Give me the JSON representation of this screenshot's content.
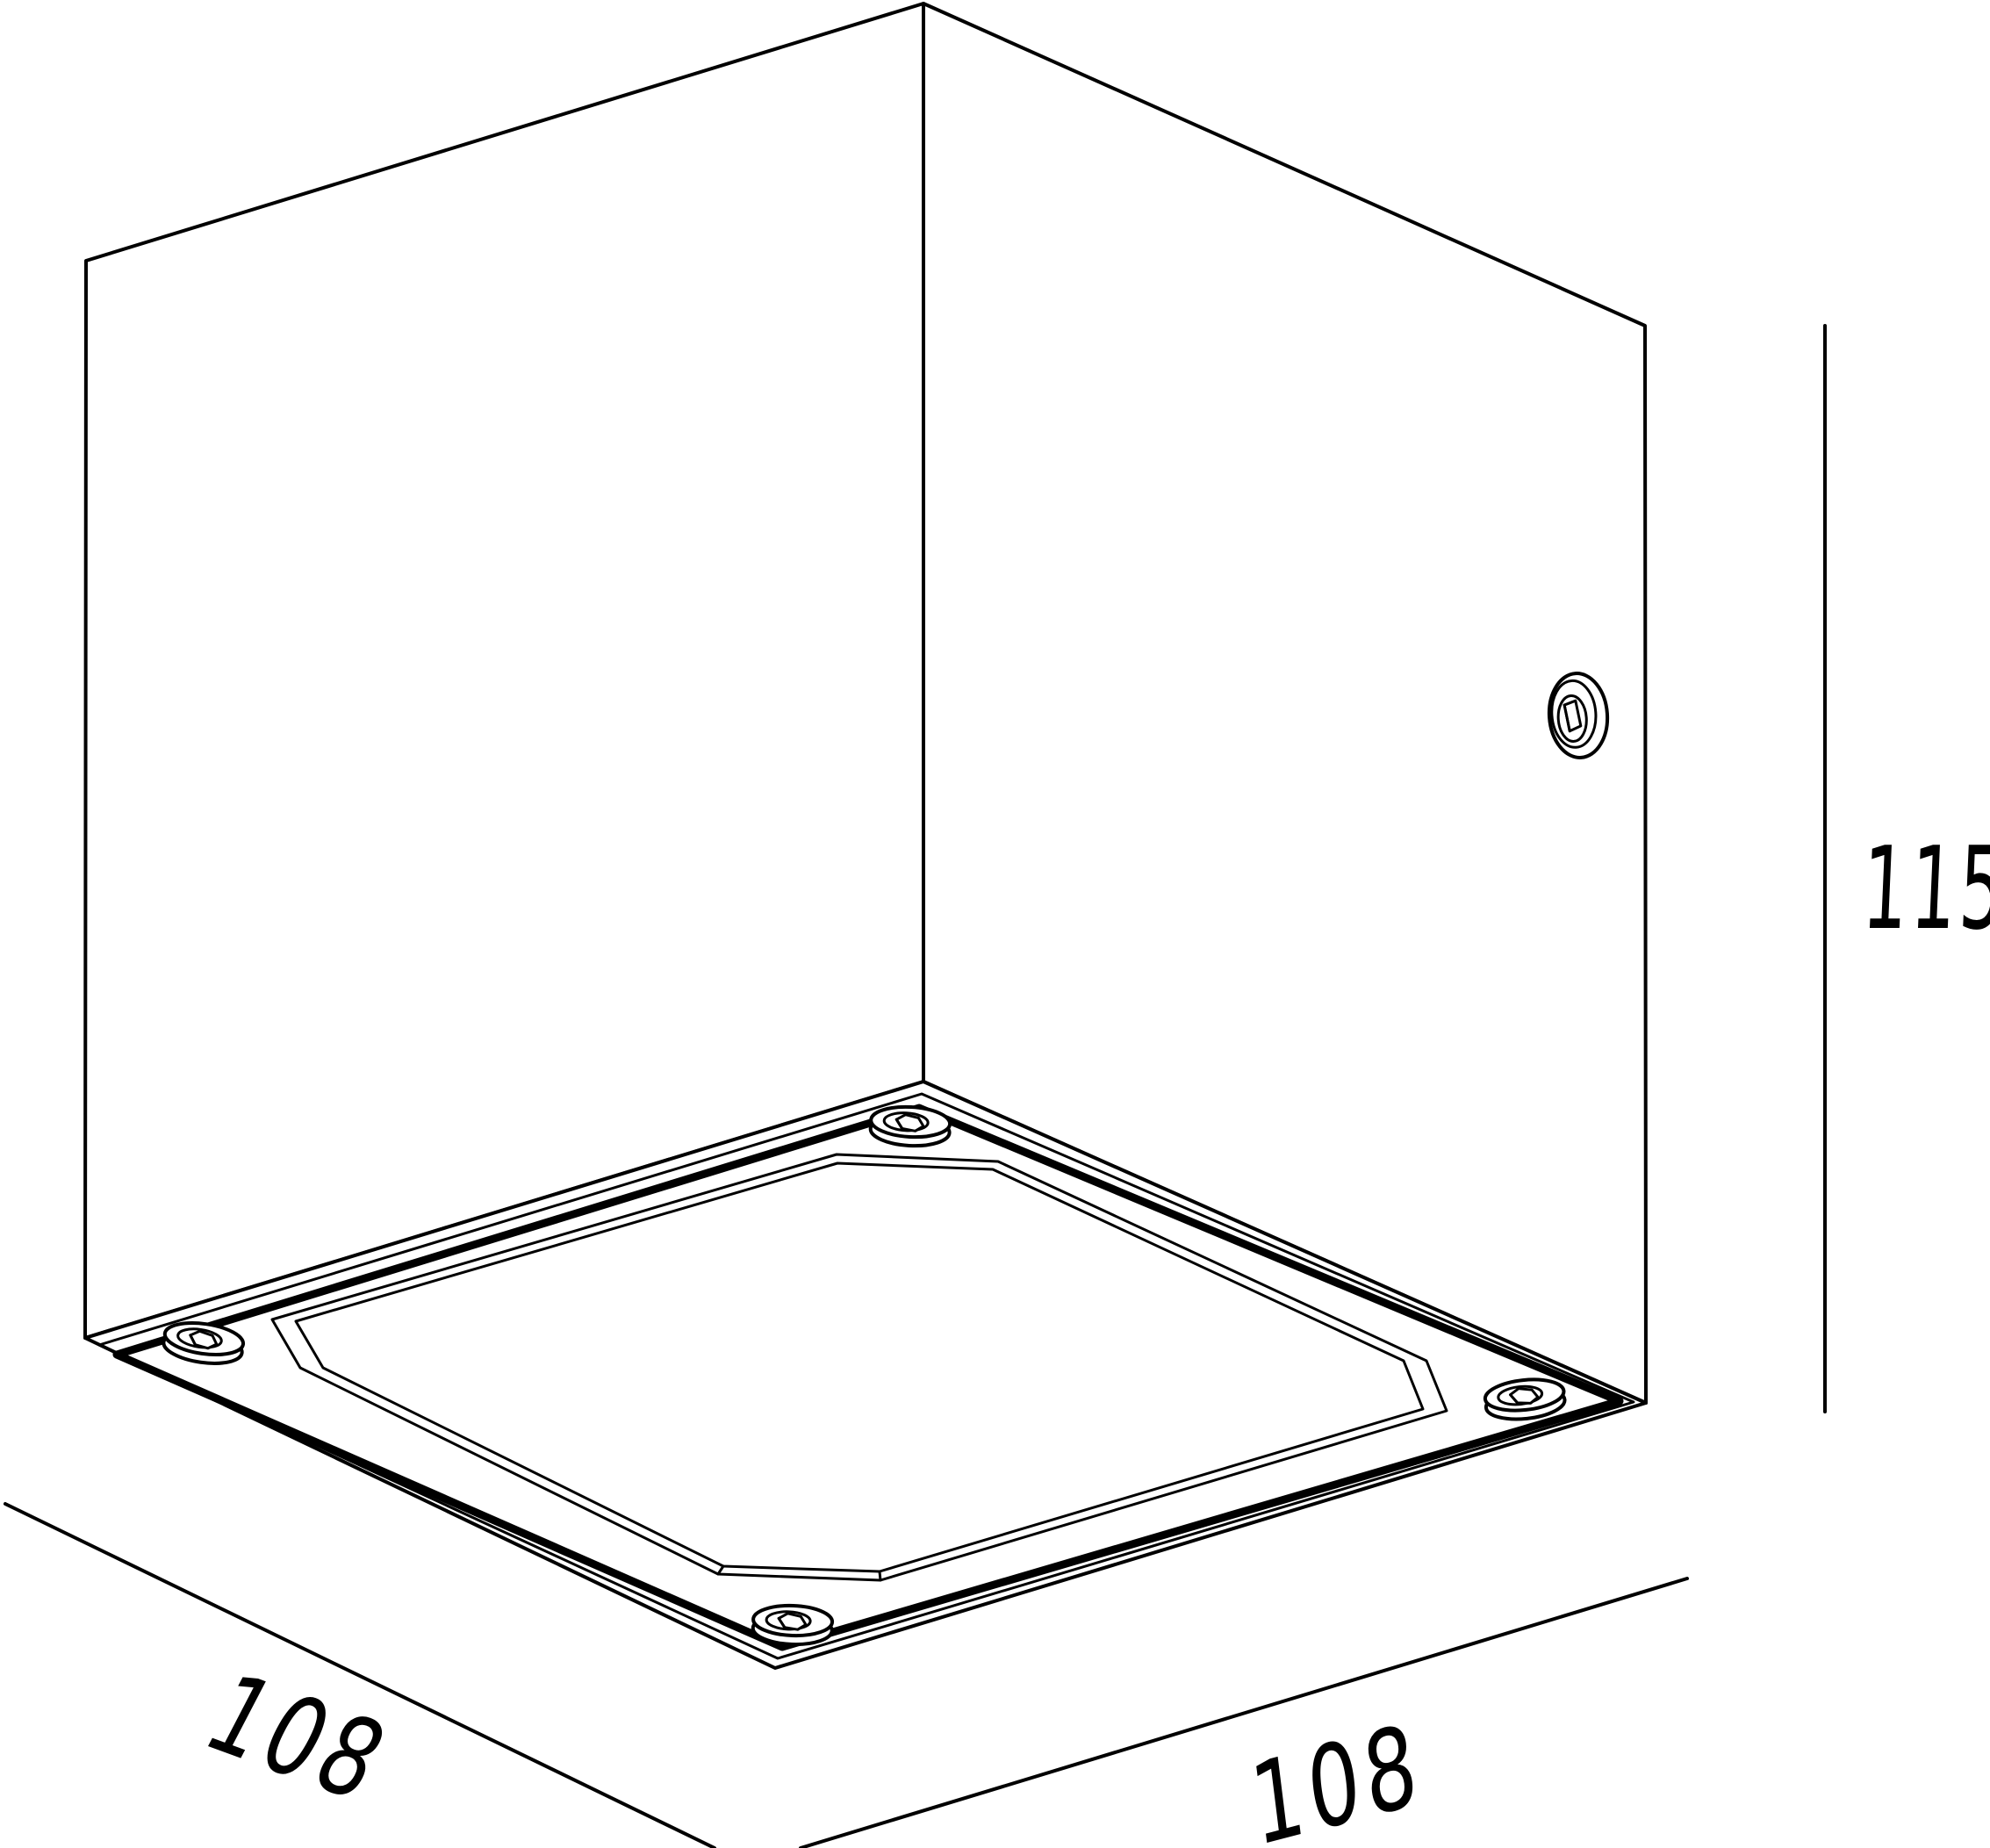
{
  "page": {
    "background_color": "#ffffff",
    "stroke_color": "#000000"
  },
  "drawing": {
    "subject": "cube-luminaire-dimension-drawing",
    "labels": {
      "width_left": "108",
      "width_right": "108",
      "height": "115"
    }
  }
}
